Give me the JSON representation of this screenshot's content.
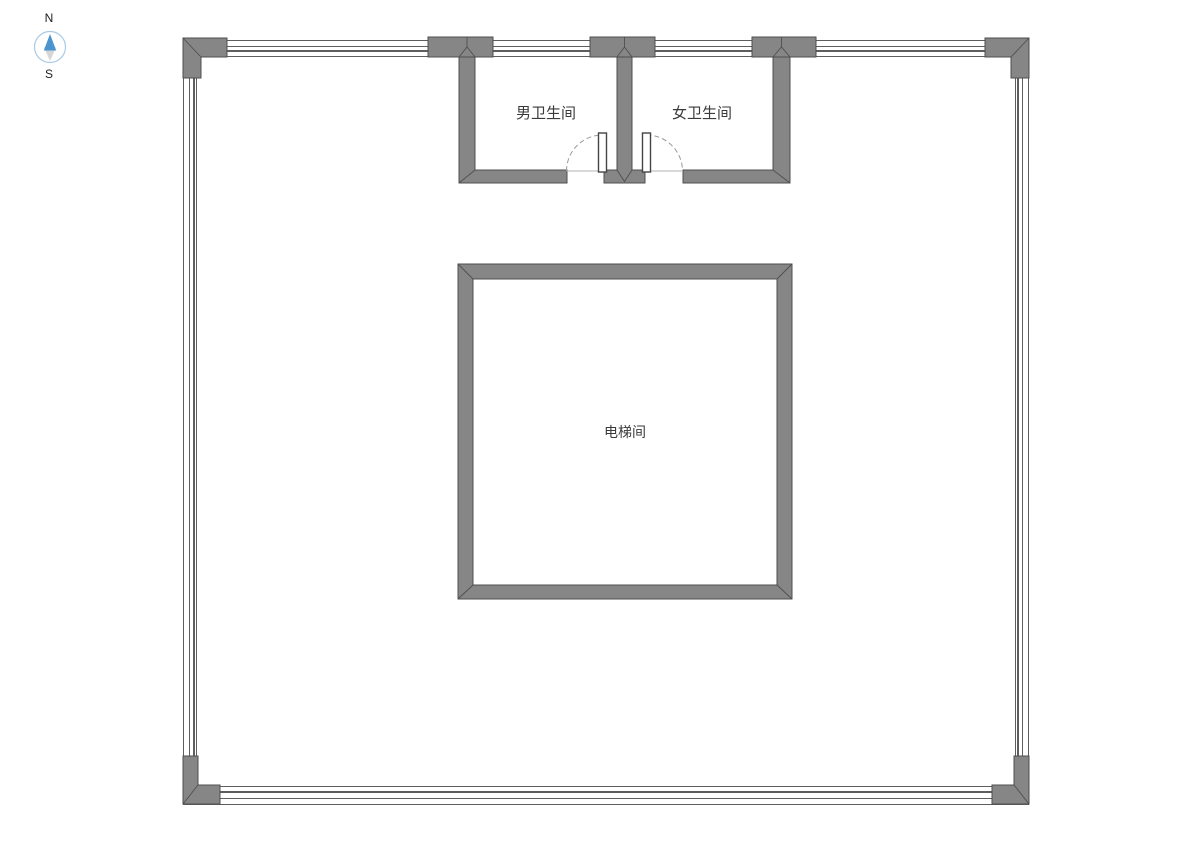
{
  "compass": {
    "north_label": "N",
    "south_label": "S"
  },
  "rooms": {
    "mens_restroom": {
      "label": "男卫生间"
    },
    "womens_restroom": {
      "label": "女卫生间"
    },
    "elevator": {
      "label": "电梯间"
    }
  },
  "colors": {
    "wall_fill": "#868686",
    "wall_outline": "#4f4f4f",
    "wall_line": "#5e5e5e",
    "door_leaf_outline": "#444444",
    "door_arc": "#9a9a9a",
    "threshold": "#b3b3b3",
    "label_text": "#3a3a3a",
    "compass_ring": "#a9cbe6",
    "compass_north": "#4a94d0",
    "compass_south": "#d6d6d6",
    "page_bg": "#ffffff"
  }
}
